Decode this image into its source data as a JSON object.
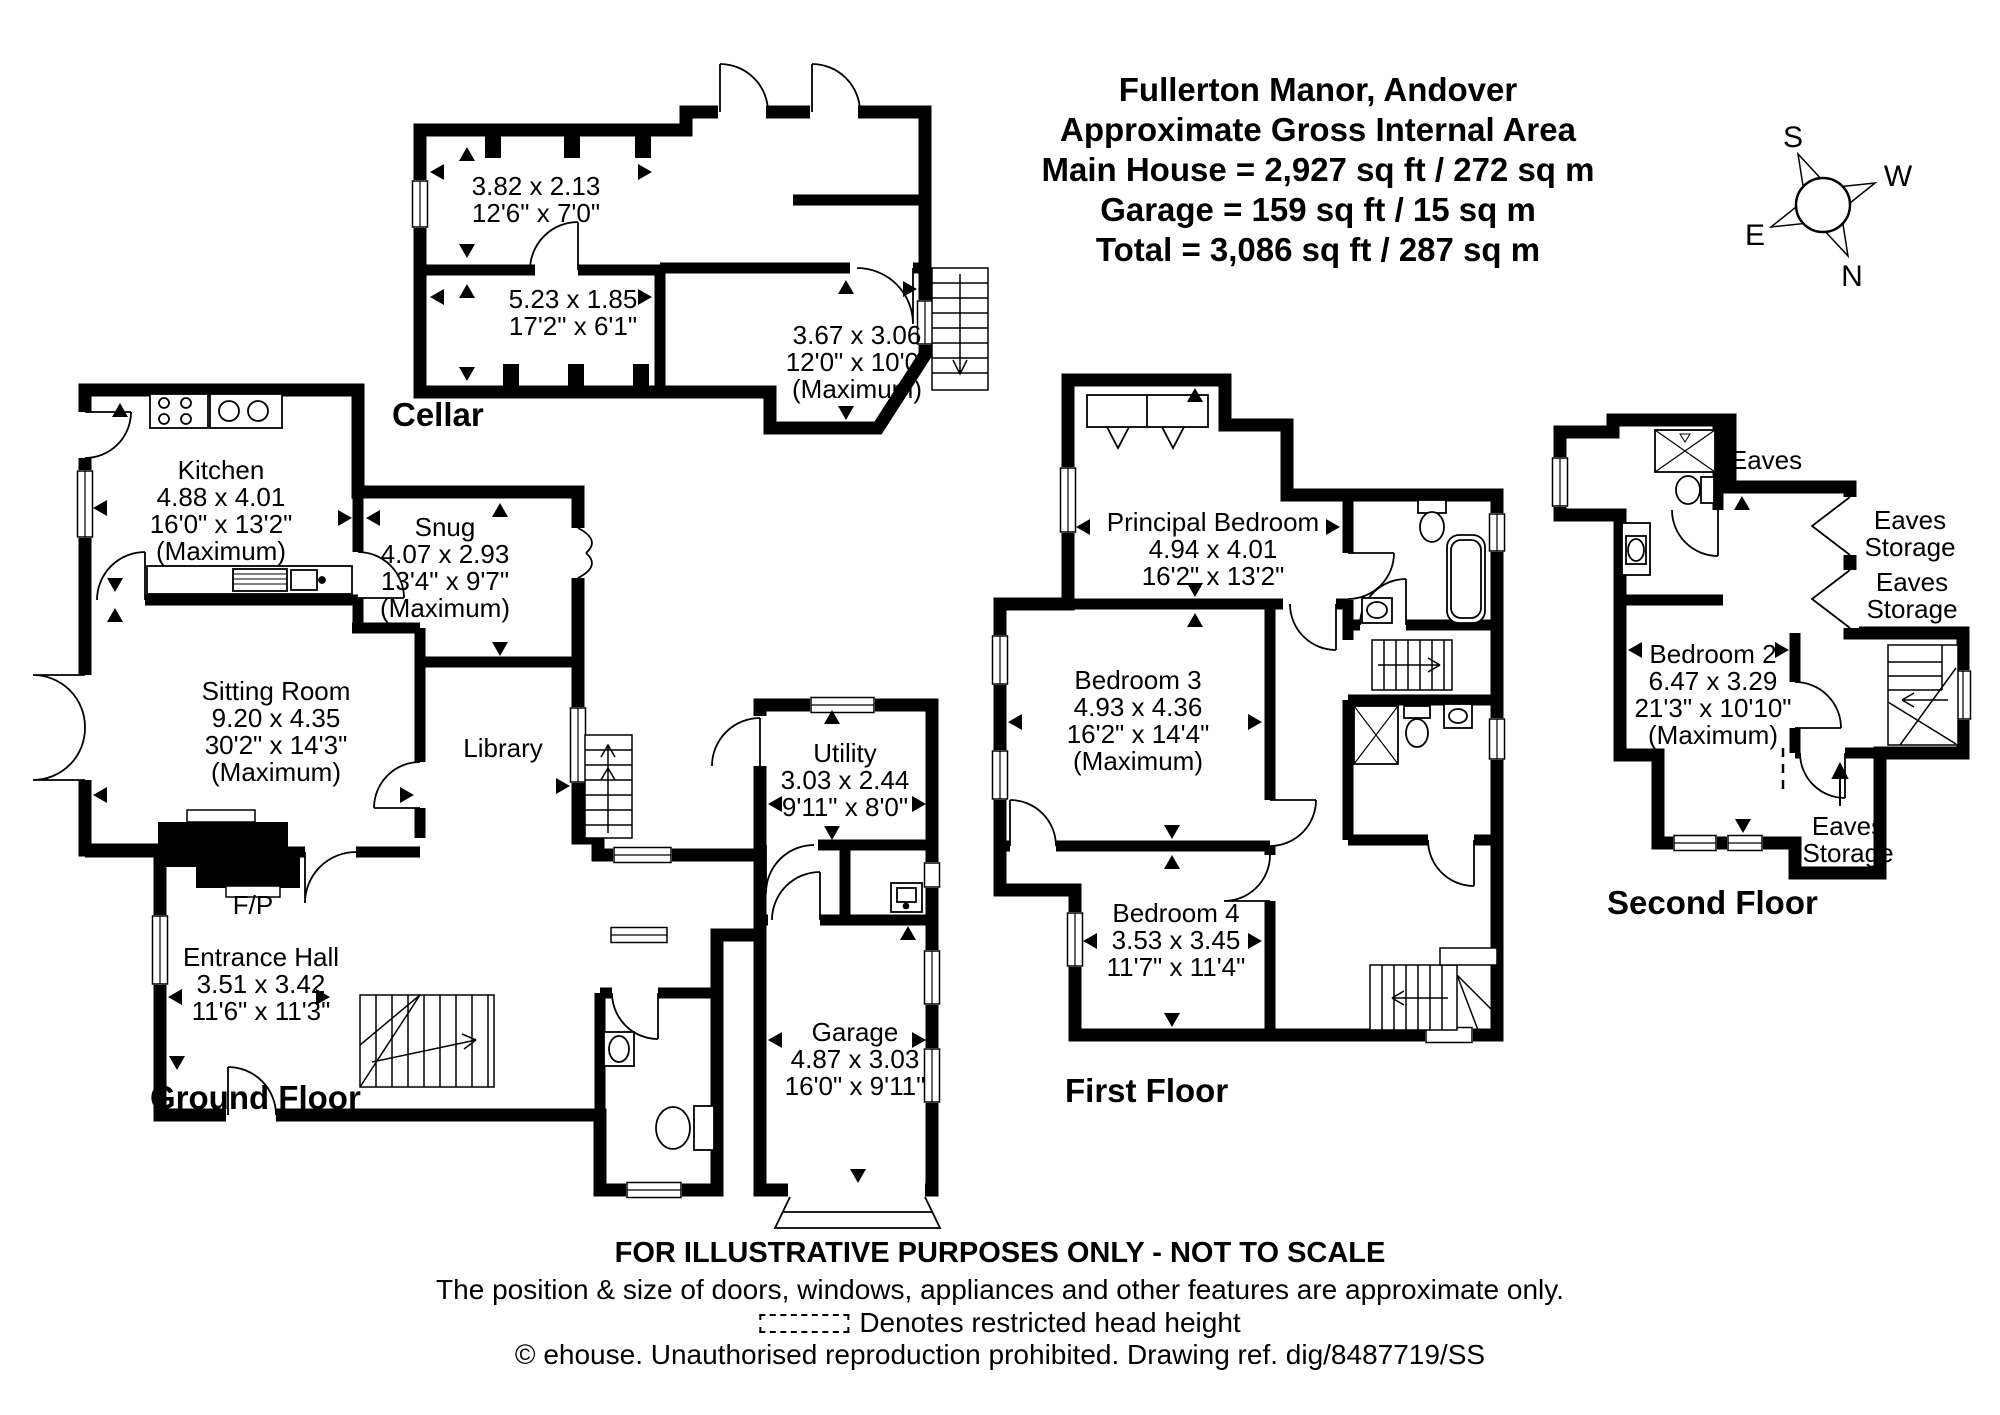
{
  "header": {
    "lines": [
      "Fullerton Manor, Andover",
      "Approximate Gross Internal Area",
      "Main House = 2,927 sq ft / 272 sq m",
      "Garage = 159 sq ft / 15 sq m",
      "Total = 3,086 sq ft / 287 sq m"
    ]
  },
  "compass": {
    "n": "N",
    "s": "S",
    "e": "E",
    "w": "W"
  },
  "floors": {
    "cellar": {
      "title": "Cellar",
      "rooms": {
        "store1": {
          "lines": [
            "3.82 x 2.13",
            "12'6\" x 7'0\""
          ]
        },
        "store2": {
          "lines": [
            "5.23 x 1.85",
            "17'2\" x 6'1\""
          ]
        },
        "store3": {
          "lines": [
            "3.67 x 3.06",
            "12'0\" x 10'0\"",
            "(Maximum)"
          ]
        }
      }
    },
    "ground": {
      "title": "Ground Floor",
      "rooms": {
        "kitchen": {
          "lines": [
            "Kitchen",
            "4.88 x 4.01",
            "16'0\" x 13'2\"",
            "(Maximum)"
          ]
        },
        "snug": {
          "lines": [
            "Snug",
            "4.07 x 2.93",
            "13'4\" x 9'7\"",
            "(Maximum)"
          ]
        },
        "sitting": {
          "lines": [
            "Sitting Room",
            "9.20 x 4.35",
            "30'2\" x 14'3\"",
            "(Maximum)"
          ]
        },
        "library": {
          "lines": [
            "Library"
          ]
        },
        "fireplace": {
          "lines": [
            "F/P"
          ]
        },
        "entrance": {
          "lines": [
            "Entrance Hall",
            "3.51 x 3.42",
            "11'6\" x 11'3\""
          ]
        },
        "utility": {
          "lines": [
            "Utility",
            "3.03 x 2.44",
            "9'11\" x 8'0\""
          ]
        },
        "garage": {
          "lines": [
            "Garage",
            "4.87 x 3.03",
            "16'0\" x 9'11\""
          ]
        }
      }
    },
    "first": {
      "title": "First Floor",
      "rooms": {
        "principal": {
          "lines": [
            "Principal Bedroom",
            "4.94 x 4.01",
            "16'2\" x 13'2\""
          ]
        },
        "bedroom3": {
          "lines": [
            "Bedroom 3",
            "4.93 x 4.36",
            "16'2\" x 14'4\"",
            "(Maximum)"
          ]
        },
        "bedroom4": {
          "lines": [
            "Bedroom 4",
            "3.53 x 3.45",
            "11'7\" x 11'4\""
          ]
        }
      }
    },
    "second": {
      "title": "Second Floor",
      "rooms": {
        "bedroom2": {
          "lines": [
            "Bedroom 2",
            "6.47 x 3.29",
            "21'3\" x 10'10\"",
            "(Maximum)"
          ]
        }
      },
      "annotations": {
        "eaves": {
          "lines": [
            "Eaves"
          ]
        },
        "storage1": {
          "lines": [
            "Eaves",
            "Storage"
          ]
        },
        "storage2": {
          "lines": [
            "Eaves",
            "Storage"
          ]
        },
        "storage3": {
          "lines": [
            "Eaves",
            "Storage"
          ]
        }
      }
    }
  },
  "footer": {
    "line1": "FOR ILLUSTRATIVE PURPOSES ONLY - NOT TO SCALE",
    "line2": "The position & size of doors, windows, appliances and other features are approximate only.",
    "line3": "Denotes restricted head height",
    "line4": "© ehouse. Unauthorised reproduction prohibited. Drawing ref. dig/8487719/SS"
  }
}
